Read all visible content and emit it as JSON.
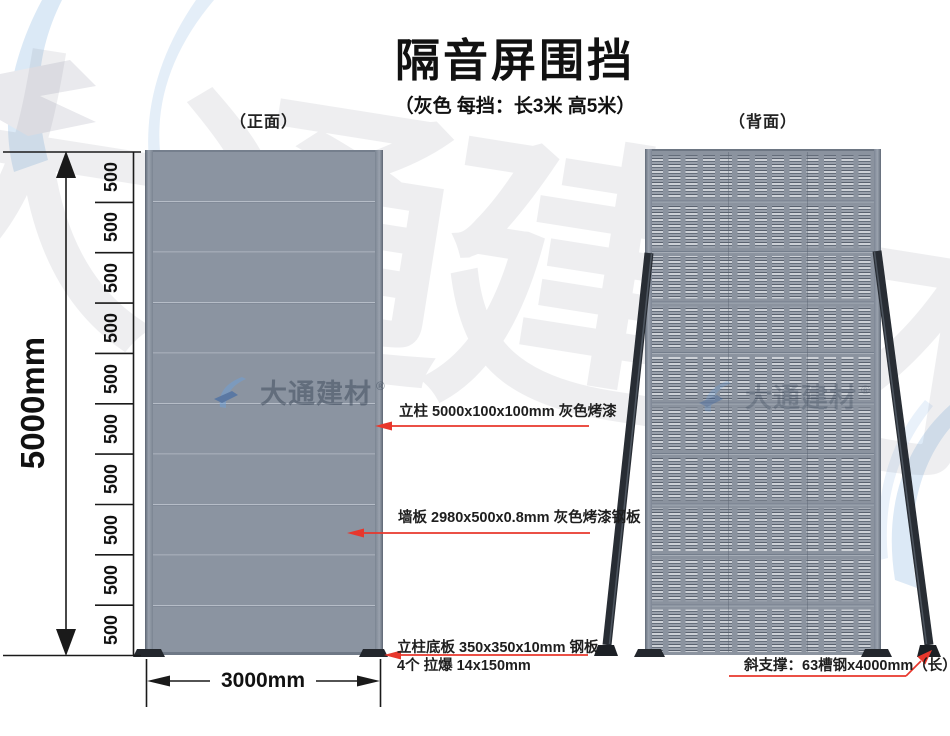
{
  "page": {
    "title": "隔音屏围挡",
    "subtitle": "（灰色  每挡：长3米 高5米）"
  },
  "views": {
    "front_label": "（正面）",
    "back_label": "（背面）"
  },
  "dimensions": {
    "height_total": "5000mm",
    "width_total": "3000mm",
    "segment": "500",
    "segment_count": 10
  },
  "annotations": {
    "post": "立柱 5000x100x100mm 灰色烤漆",
    "panel": "墙板 2980x500x0.8mm 灰色烤漆钢板",
    "base_line1": "立柱底板 350x350x10mm 钢板",
    "base_line2": "4个 拉爆 14x150mm",
    "brace": "斜支撑：63槽钢x4000mm（长）"
  },
  "watermark": {
    "brand": "大通建材",
    "reg": "®",
    "ghost": "大通建材"
  },
  "colors": {
    "panel_gray": "#8b94a1",
    "accent_red": "#e8372c",
    "steel_dark": "#282d34",
    "watermark_blue": "#dbe9f6"
  }
}
